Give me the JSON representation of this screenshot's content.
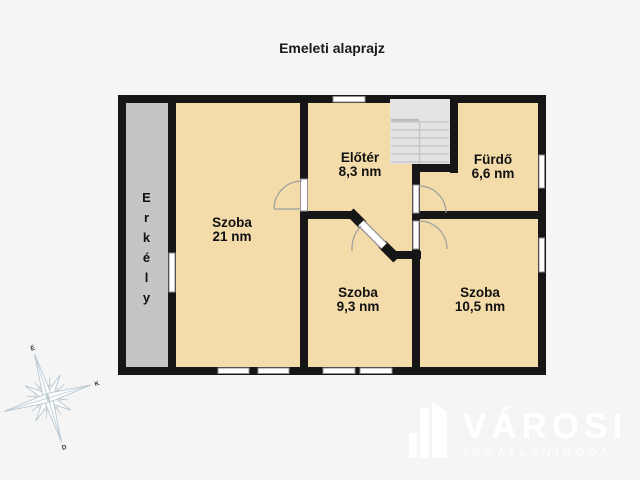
{
  "title": "Emeleti alaprajz",
  "rooms": {
    "szoba21": {
      "name": "Szoba",
      "area": "21 nm"
    },
    "eloter": {
      "name": "Előtér",
      "area": "8,3 nm"
    },
    "furdo": {
      "name": "Fürdő",
      "area": "6,6 nm"
    },
    "szoba93": {
      "name": "Szoba",
      "area": "9,3 nm"
    },
    "szoba105": {
      "name": "Szoba",
      "area": "10,5 nm"
    },
    "erkely": {
      "name": "Erkély"
    }
  },
  "compass": {
    "north": "É",
    "east": "K",
    "south": "D"
  },
  "logo": {
    "brand": "VÁROSI",
    "tagline": "INGATLANIRODA"
  },
  "colors": {
    "background": "#f5f5f6",
    "floor": "#f3dbaa",
    "balcony": "#c5c5c5",
    "wall": "#161616",
    "stairs": "#e4e4e4",
    "logo": "#ffffff"
  }
}
